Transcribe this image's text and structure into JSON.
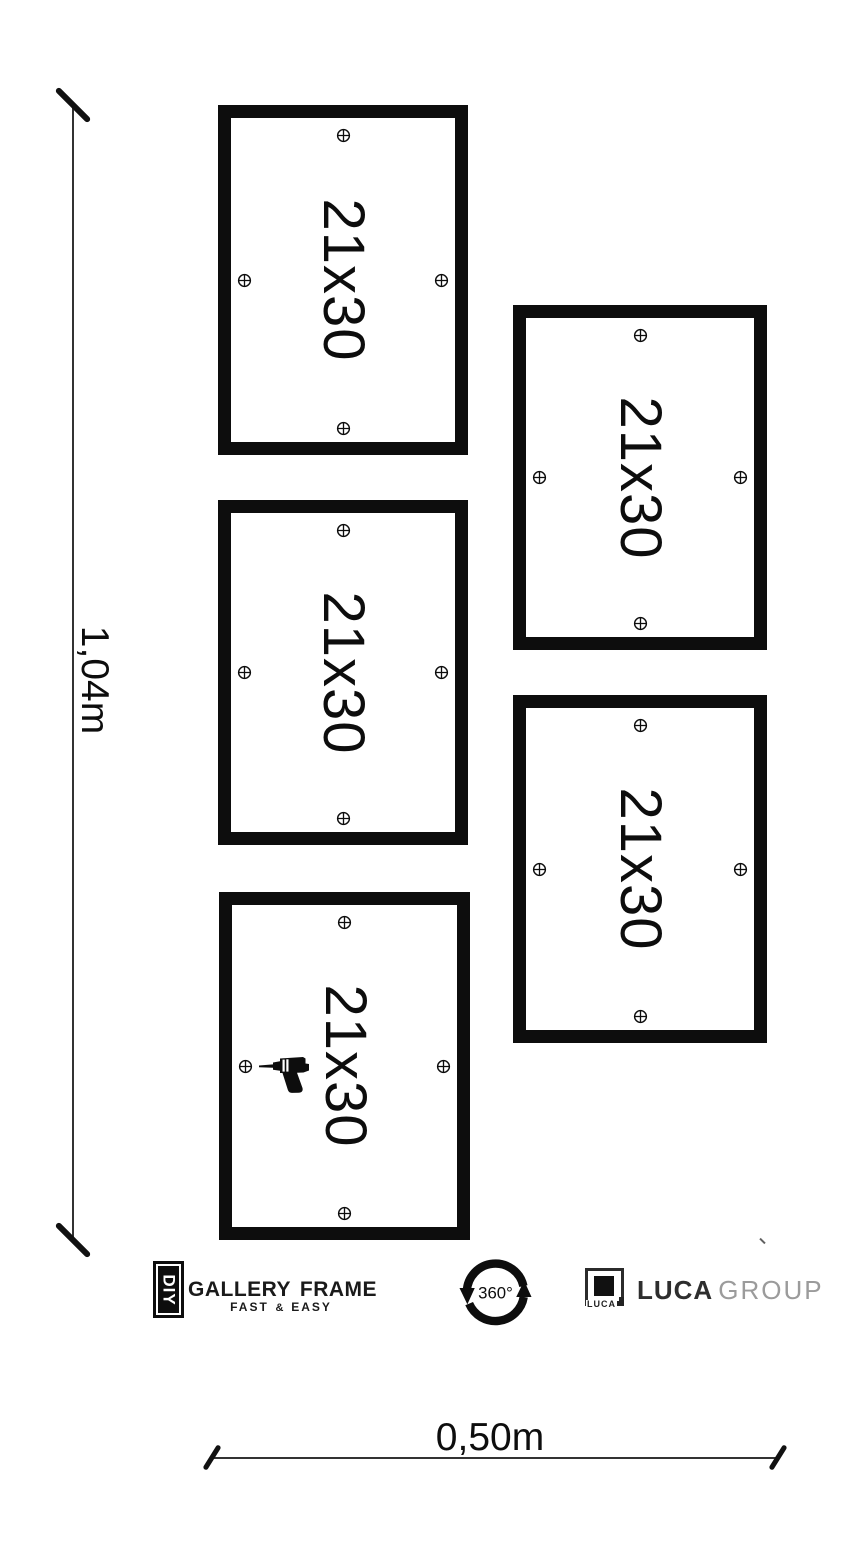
{
  "diagram": {
    "title": "gallery-frame-hanging-template",
    "height_label": "1,04m",
    "width_label": "0,50m"
  },
  "frames": [
    {
      "id": "top-left",
      "label": "21x30"
    },
    {
      "id": "middle-left",
      "label": "21x30"
    },
    {
      "id": "bottom-left",
      "label": "21x30",
      "has_drill_icon": true
    },
    {
      "id": "top-right",
      "label": "21x30"
    },
    {
      "id": "bottom-right",
      "label": "21x30"
    }
  ],
  "branding": {
    "diy_badge": "DIY",
    "brand_name": "Gallery Frame",
    "tagline_left": "Fast",
    "tagline_amp": "&",
    "tagline_right": "Easy",
    "rotation_badge": "360°",
    "company_name": "LUCA",
    "company_suffix": "GROUP",
    "logo_caption": "LUCA"
  },
  "icons": {
    "mount_marker": "circled-plus-drill-point",
    "drill": "power-drill",
    "rotation": "360-degree-circular-arrows"
  },
  "colors": {
    "ink": "#0d0d0d",
    "dim_line": "#333333",
    "company_suffix_gray": "#9b9b9b",
    "background": "#ffffff"
  }
}
